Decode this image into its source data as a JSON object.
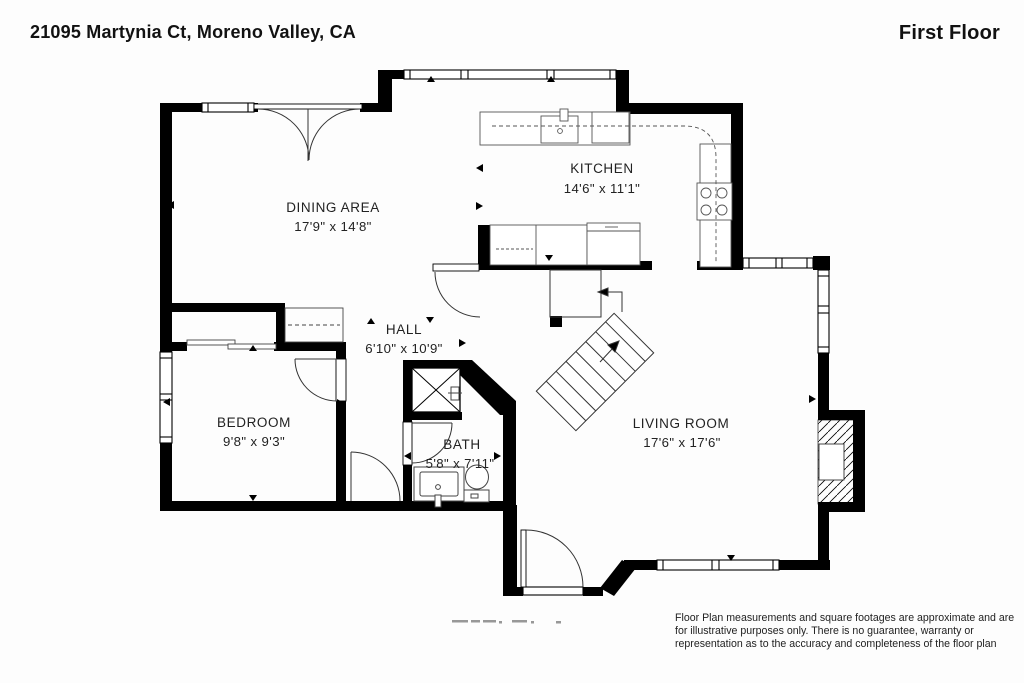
{
  "header": {
    "address": "21095 Martynia Ct, Moreno Valley, CA",
    "floor_label": "First Floor"
  },
  "rooms": {
    "dining": {
      "name": "DINING AREA",
      "dims": "17'9\" x 14'8\""
    },
    "kitchen": {
      "name": "KITCHEN",
      "dims": "14'6\" x 11'1\""
    },
    "hall": {
      "name": "HALL",
      "dims": "6'10\" x 10'9\""
    },
    "bedroom": {
      "name": "BEDROOM",
      "dims": "9'8\" x 9'3\""
    },
    "bath": {
      "name": "BATH",
      "dims": "5'8\" x 7'11\""
    },
    "living": {
      "name": "LIVING ROOM",
      "dims": "17'6\" x 17'6\""
    }
  },
  "footer": {
    "disclaimer": "Floor Plan measurements and square footages are approximate and are for illustrative purposes only. There is no guarantee, warranty or representation as to the accuracy and completeness of the floor plan"
  },
  "colors": {
    "wall": "#000000",
    "background": "#fdfdfd",
    "label_text": "#222222"
  }
}
